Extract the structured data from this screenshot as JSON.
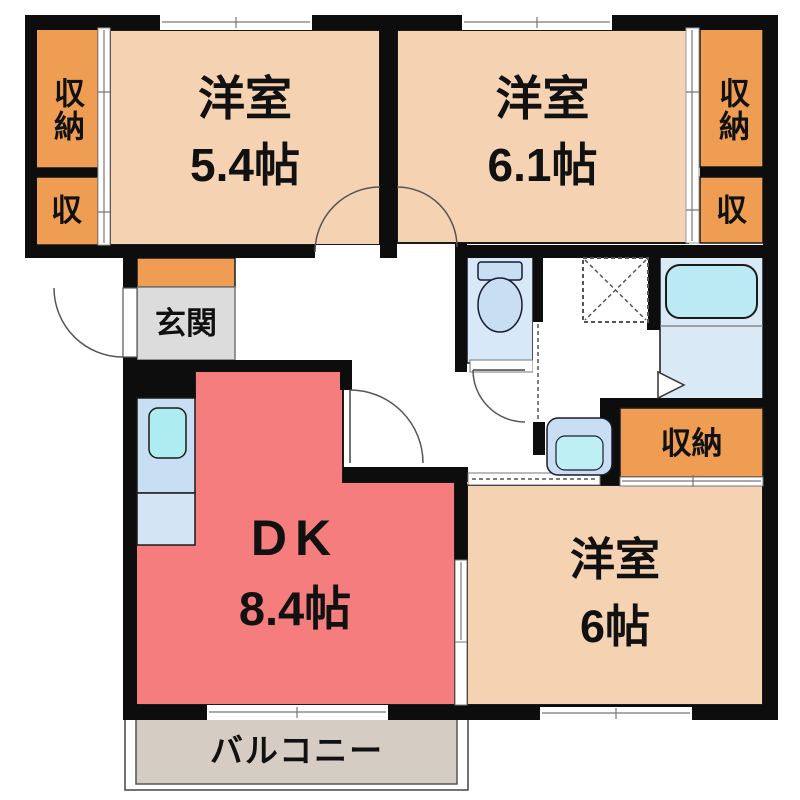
{
  "title": "2DK間取り図",
  "colors": {
    "wall": "#0d0d0d",
    "room": "#F4D2B2",
    "closet": "#EF9D52",
    "dk": "#F57D7D",
    "genkan": "#DCDCDC",
    "balcony": "#D5CDC4",
    "water_floor": "#D7E8F8",
    "bath_floor": "#DAE9F6",
    "tub": "#BBEAF4",
    "counter": "#C8DEF2",
    "counter2": "#D3E5F5",
    "sink": "#ADEDF2",
    "fixture": "#C8DEF3",
    "basin_inner": "#BEEFF4",
    "text": "#111111"
  },
  "rooms": {
    "bedroom1": {
      "name": "洋室",
      "size": "5.4帖"
    },
    "bedroom2": {
      "name": "洋室",
      "size": "6.1帖"
    },
    "bedroom3": {
      "name": "洋室",
      "size": "6帖"
    },
    "dk": {
      "name": "DK",
      "size": "8.4帖"
    },
    "entrance": {
      "label": "玄関"
    },
    "balcony": {
      "label": "バルコニー"
    }
  },
  "closets": {
    "top_left_main": "収納",
    "top_left_small": "収",
    "top_right_main": "収納",
    "top_right_small": "収",
    "bottom_right": "収納"
  }
}
